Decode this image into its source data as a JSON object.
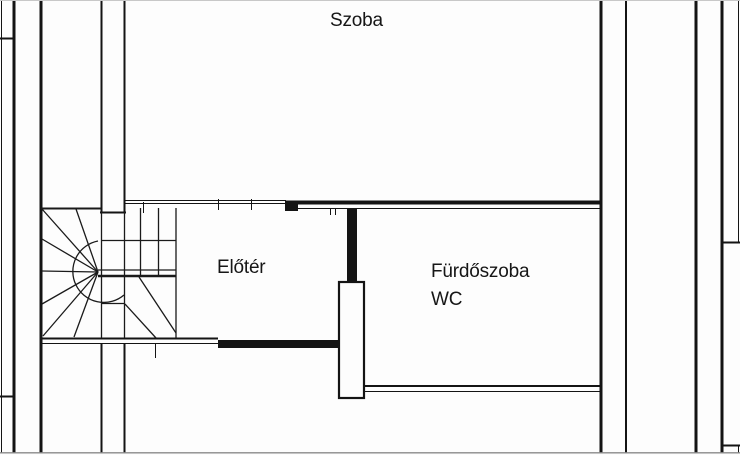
{
  "colors": {
    "background": "#fdfdfd",
    "line": "#141414",
    "scan_edge": "#8a8a8a"
  },
  "rooms": [
    {
      "id": "szoba",
      "label": "Szoba"
    },
    {
      "id": "eloter",
      "label": "Előtér"
    },
    {
      "id": "furdoszoba",
      "label": "Fürdőszoba"
    },
    {
      "id": "wc",
      "label": "WC"
    }
  ]
}
